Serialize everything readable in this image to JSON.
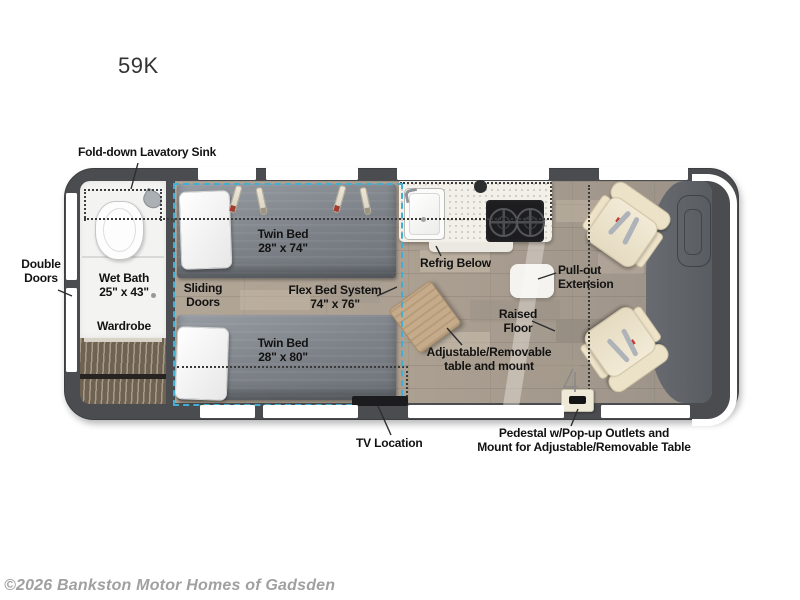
{
  "page": {
    "title": "59K",
    "copyright": "©2026 Bankston Motor Homes of Gadsden"
  },
  "floorplan": {
    "model": "59K",
    "labels": {
      "fold_down_sink": "Fold-down Lavatory Sink",
      "double_doors": "Double Doors",
      "wet_bath_name": "Wet Bath",
      "wet_bath_dim": "25\" x 43\"",
      "wardrobe": "Wardrobe",
      "sliding_doors": "Sliding Doors",
      "twin_bed_top_name": "Twin Bed",
      "twin_bed_top_dim": "28\" x 74\"",
      "twin_bed_bottom_name": "Twin Bed",
      "twin_bed_bottom_dim": "28\" x 80\"",
      "flex_bed_name": "Flex Bed System",
      "flex_bed_dim": "74\" x 76\"",
      "refrig_below": "Refrig Below",
      "pull_out_extension": "Pull-out Extension",
      "raised_floor": "Raised Floor",
      "adjustable_table": "Adjustable/Removable table and mount",
      "tv_location": "TV Location",
      "pedestal_line1": "Pedestal w/Pop-up Outlets and",
      "pedestal_line2": "Mount for Adjustable/Removable Table"
    },
    "colors": {
      "body_wall": "#4a4c4f",
      "floor_wood": "#b3a898",
      "flex_bed_outline": "#42aed2",
      "mattress_gray": "#7c8187",
      "seat_cream": "#efe7d2",
      "counter_white": "#f2f0e9",
      "stove_black": "#1d1d1f",
      "label_text": "#121212",
      "copyright_text": "#a0a0a0"
    }
  }
}
